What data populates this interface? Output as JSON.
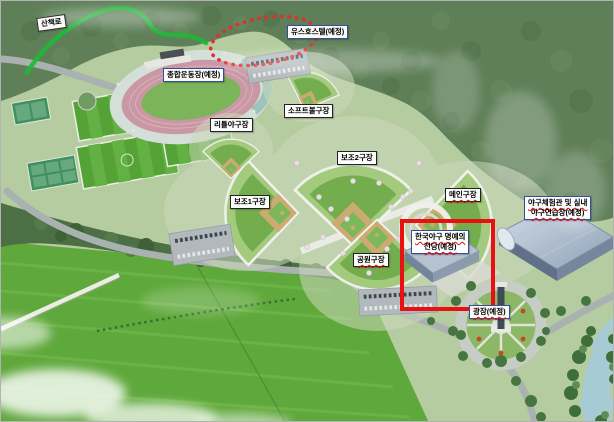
{
  "figure": {
    "kind": "aerial-site-plan-rendering",
    "subject": "baseball-park-complex"
  },
  "labels": {
    "trail": {
      "text": "산책로",
      "style": "plain"
    },
    "youth_hostel": {
      "text": "유스호스텔(예정)",
      "style": "blue-border"
    },
    "general_stadium": {
      "text": "종합운동장(예정)",
      "style": "blue-border"
    },
    "softball_field": {
      "text": "소프트볼구장",
      "style": "black-border"
    },
    "little_league_field": {
      "text": "리틀야구장",
      "style": "black-border"
    },
    "aux_field_2": {
      "text": "보조2구장",
      "style": "black-border"
    },
    "aux_field_1": {
      "text": "보조1구장",
      "style": "black-border"
    },
    "main_field": {
      "text": "메인구장",
      "style": "black-border",
      "spellcheck_underline": true
    },
    "experience_center": {
      "line1": "야구체험관 및 실내",
      "line2": "야구연습장(예정)",
      "style": "blue-border",
      "spellcheck_underline": true
    },
    "park_field": {
      "text": "공원구장",
      "style": "black-border",
      "spellcheck_underline": true
    },
    "hall_of_fame": {
      "line1": "한국야구 명예의",
      "line2": "전당(예정)",
      "style": "blue-border",
      "spellcheck_underline": true
    },
    "plaza": {
      "text": "광장(예정)",
      "style": "blue-border",
      "spellcheck_underline": true
    }
  },
  "annotations": {
    "walking_trail_line": {
      "shape": "curved-line",
      "color": "#1fb838"
    },
    "planned_site_ellipse": {
      "shape": "dotted-ellipse",
      "color": "#e03028"
    },
    "hall_of_fame_highlight_box": {
      "shape": "rectangle",
      "color": "#e81010"
    }
  },
  "colors": {
    "highlight_red": "#e81010",
    "trail_green": "#1fb838",
    "dotted_ellipse_red": "#e03028",
    "label_border_blue": "#2f4f9e",
    "label_border_black": "#222222",
    "forest_green": "#5e7f58",
    "farmland_green": "#5fa83b",
    "field_grass_green": "#74ad4e",
    "infield_dirt_tan": "#cbab72",
    "running_track_pink": "#c998a4",
    "road_gray": "#a9b2b0",
    "building_roof_blue_gray": "#9fb2c8",
    "water_blue": "#a6cbd4"
  }
}
